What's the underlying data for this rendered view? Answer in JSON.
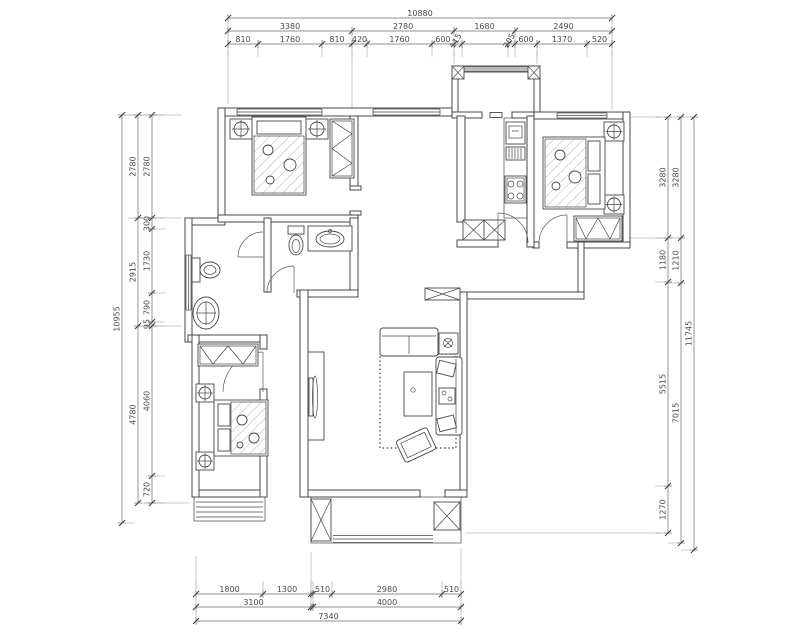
{
  "drawing_type": "apartment-floor-plan",
  "colors": {
    "line": "#474747",
    "dimension_line": "#6a6a6a",
    "text": "#4a4a4a",
    "background": "#ffffff"
  },
  "dimensions_mm": {
    "top": {
      "total": "10880",
      "middle_row": [
        "3380",
        "2780",
        "1680",
        "2490"
      ],
      "inner_row": [
        "810",
        "1760",
        "810",
        "420",
        "1760",
        "600",
        "115",
        "",
        "205",
        "600",
        "1370",
        "520"
      ]
    },
    "left": {
      "total": "10955",
      "middle_column": [
        "2780",
        "2915",
        "4780"
      ],
      "inner_column": [
        "2780",
        "300",
        "1730",
        "790",
        "95",
        "4060",
        "720"
      ]
    },
    "right": {
      "total": "11745",
      "middle_column": [
        "3280",
        "1210",
        "7015"
      ],
      "inner_column": [
        "3280",
        "1180",
        "5515",
        "1270"
      ]
    },
    "bottom": {
      "total": "7340",
      "middle_row": [
        "3100",
        "4000"
      ],
      "inner_row_left": [
        "1800",
        "1300"
      ],
      "inner_row_right": [
        "510",
        "2980",
        "510"
      ]
    }
  }
}
